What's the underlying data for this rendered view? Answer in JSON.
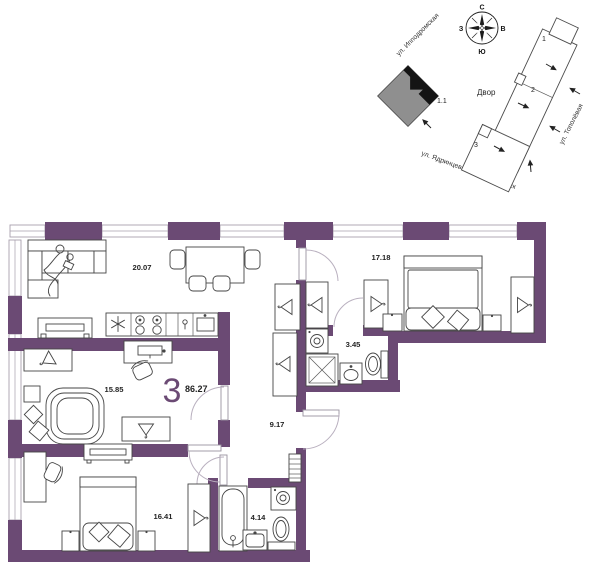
{
  "site_plan": {
    "compass": {
      "n": "С",
      "e": "В",
      "s": "Ю",
      "w": "З"
    },
    "street_ippodromskaya": "ул. Ипподромская",
    "street_topolyovaya": "ул. Тополёвая",
    "street_yadrintsevsky": "ул. Ядринцевский конный спуск",
    "courtyard": "Двор",
    "building_mark": "1.1",
    "section_1": "1",
    "section_2": "2",
    "section_3": "3"
  },
  "apartment": {
    "rooms_count": "3",
    "total_area": "86.27",
    "areas": {
      "living_kitchen": "20.07",
      "bedroom_1": "17.18",
      "bathroom_1": "3.45",
      "room": "15.85",
      "hall": "9.17",
      "bedroom_2": "16.41",
      "bathroom_2": "4.14"
    }
  },
  "colors": {
    "wall": "#6b4a74",
    "site_gray": "#8f8f8f"
  }
}
